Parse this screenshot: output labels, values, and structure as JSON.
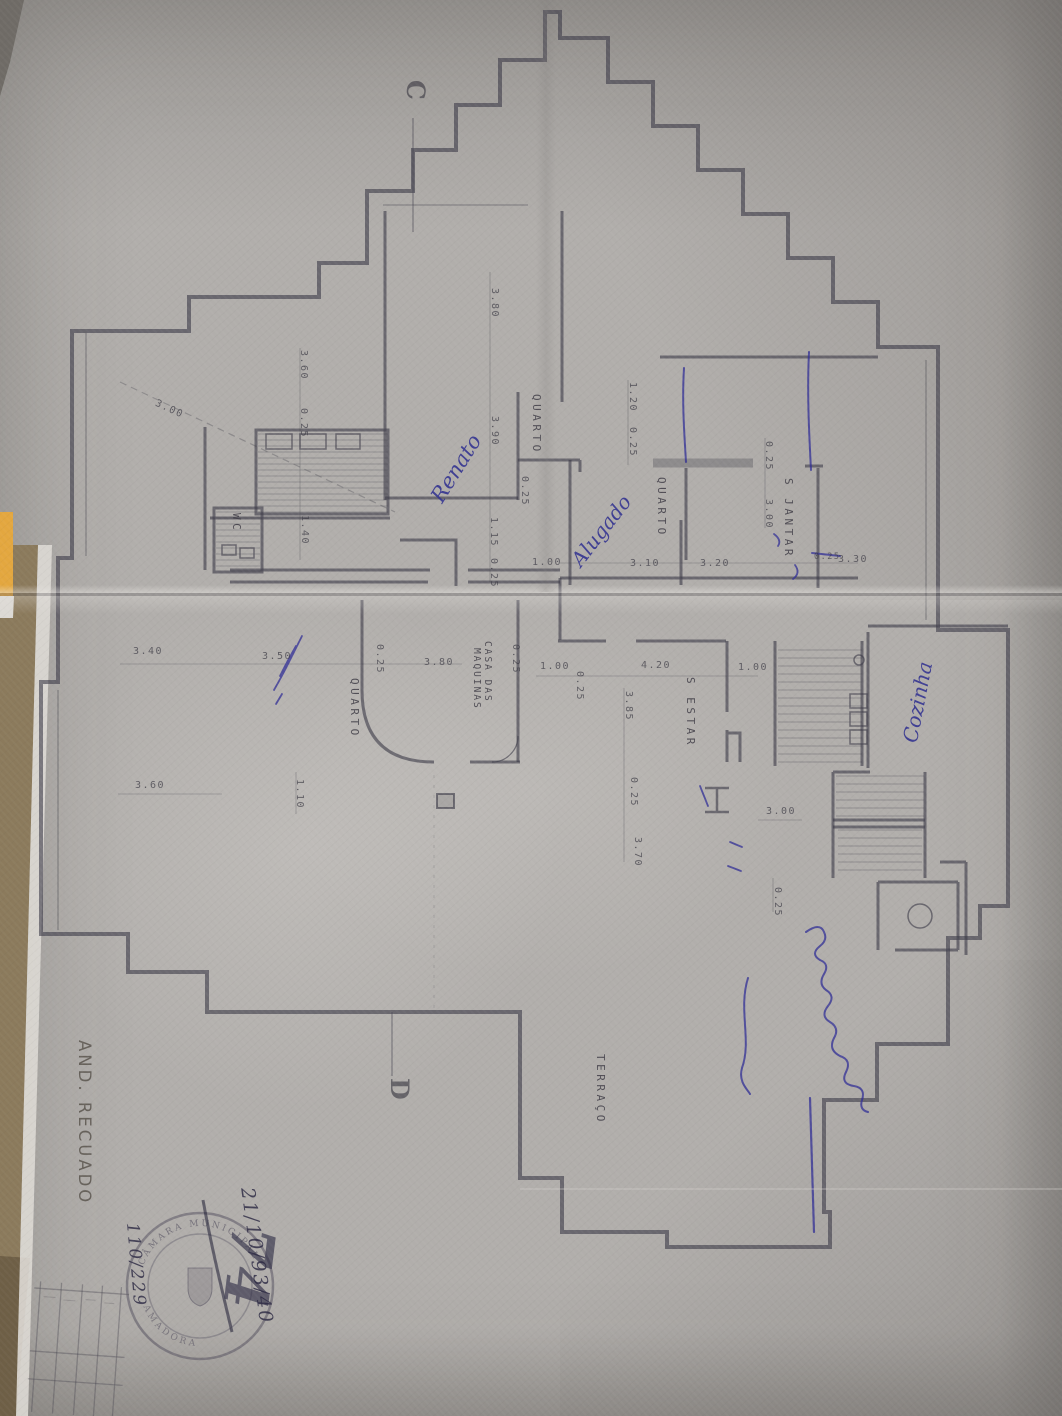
{
  "plan": {
    "section_c": "C",
    "section_d": "D",
    "rooms": {
      "quarto_upper": "QUARTO",
      "quarto_rented": "QUARTO",
      "sala_jantar": "S JANTAR",
      "wc": "WC",
      "quarto_lower": "QUARTO",
      "casa_das": "CASA DAS",
      "maquinas": "MAQUINAS",
      "sala_estar": "S ESTAR",
      "terraco": "TERRAÇO"
    },
    "dims": {
      "diag300": "3.00",
      "v360": "3.60",
      "v025a": "0.25",
      "v140": "1.40",
      "v380": "3.80",
      "v390": "3.90",
      "v025b": "0.25",
      "v115": "1.15",
      "v025c": "0.25",
      "v120": "1.20",
      "v025d": "0.25",
      "v025e": "0.25",
      "v300": "3.00",
      "v385": "3.85",
      "v025f": "0.25",
      "v370": "3.70",
      "v025g": "0.25",
      "v110": "1.10",
      "v025h": "0.25",
      "v025i": "0.25",
      "v025j": "0.25",
      "h310": "3.10",
      "h320": "3.20",
      "h025": "0.25",
      "h330": "3.30",
      "h100a": "1.00",
      "h340": "3.40",
      "h350": "3.50",
      "h380": "3.80",
      "h100b": "1.00",
      "h420": "4.20",
      "h100c": "1.00",
      "h300": "3.00",
      "h360": "3.60"
    },
    "ink": {
      "renato": "Renato",
      "alugado": "Alugado",
      "cozinha": "Cozinha"
    },
    "pencil": {
      "and_recuado": "AND. RECUADO"
    },
    "stamp": {
      "arc_top": "CÂMARA MUNICIPAL",
      "arc_bottom": "AMADORA",
      "scrawl": "74",
      "code_right": "21/10/93/40",
      "code_left": "110/229"
    }
  }
}
